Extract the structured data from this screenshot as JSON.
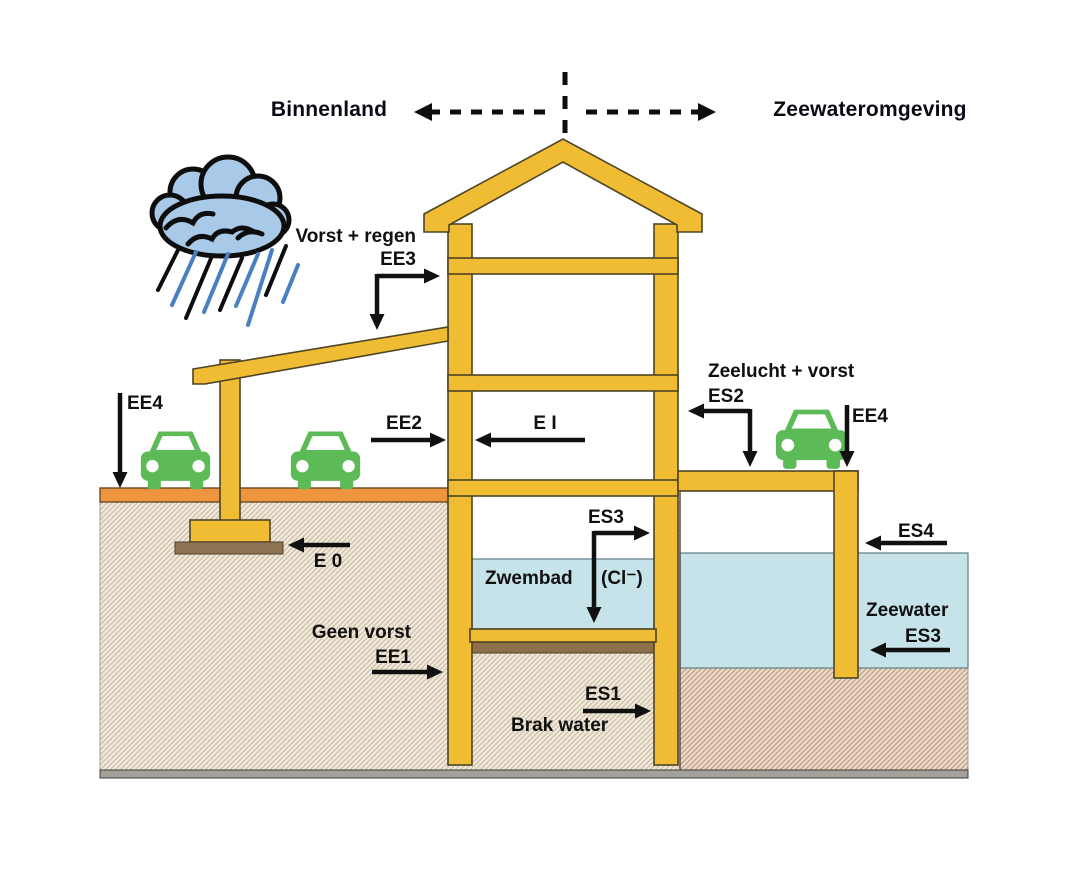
{
  "title": "Exposure classes building cross-section diagram",
  "header": {
    "left_label": "Binnenland",
    "right_label": "Zeewateromgeving"
  },
  "labels": {
    "vorst_regen": "Vorst + regen",
    "ee3": "EE3",
    "ee4_left": "EE4",
    "ee2": "EE2",
    "ei": "E I",
    "zeelucht_vorst": "Zeelucht + vorst",
    "es2": "ES2",
    "ee4_right": "EE4",
    "es3_pool": "ES3",
    "zwembad": "Zwembad",
    "chloride": "(Cl⁻)",
    "e0": "E 0",
    "geen_vorst": "Geen vorst",
    "ee1": "EE1",
    "es1": "ES1",
    "brak_water": "Brak water",
    "es4": "ES4",
    "zeewater": "Zeewater",
    "es3_sea": "ES3"
  },
  "icons": {
    "rain_cloud": "rain-cloud-icon",
    "car": "car-icon",
    "dashed_divider": "dashed-divider",
    "arrows": [
      "arrow-ee3",
      "arrow-ee4-left",
      "arrow-ee2",
      "arrow-ei",
      "arrow-es2",
      "arrow-ee4-right",
      "arrow-es3-pool",
      "arrow-e0",
      "arrow-ee1",
      "arrow-es1",
      "arrow-es4",
      "arrow-es3-sea"
    ]
  },
  "colors": {
    "structure_yellow": "#F0BC33",
    "structure_outline": "#4d4526",
    "road_orange": "#F0953F",
    "water_blue": "#C6E3E9",
    "ground_inland_bg": "#F0E9DC",
    "ground_inland_hatch": "#C9B9A2",
    "ground_sea_bg": "#EAD9C6",
    "ground_sea_hatch": "#BB9B82",
    "foundation_brown": "#8D7352",
    "pool_base_brown": "#8D6F4A",
    "base_gray": "#A3A19A",
    "car_green": "#5CBB57",
    "cloud_blue": "#A9C9E8",
    "arrow_black": "#111111"
  }
}
